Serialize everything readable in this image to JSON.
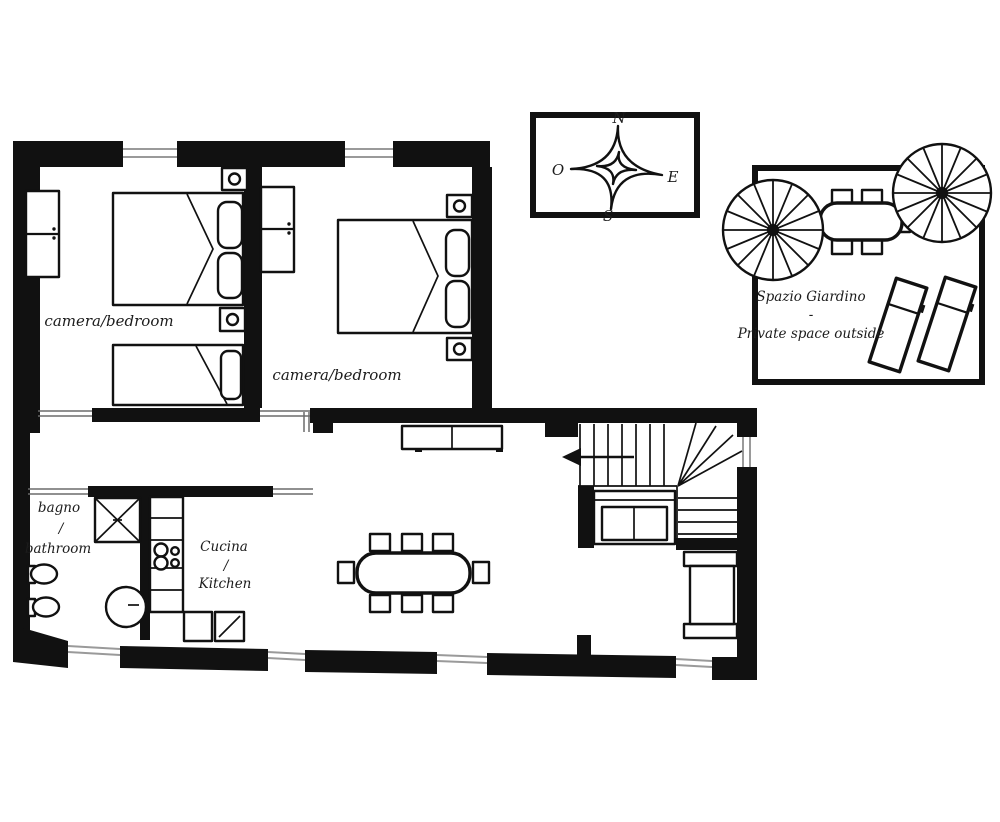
{
  "page": {
    "title": "Apartment floor plan with garden"
  },
  "colors": {
    "wall": "#111111",
    "furniture_line": "#111111",
    "window_line": "#9a9a9a",
    "door_line": "#6b6b6b",
    "background": "#ffffff"
  },
  "compass": {
    "north": "N",
    "east": "E",
    "south": "S",
    "west": "O"
  },
  "rooms": {
    "bedroom1": {
      "label": "camera/bedroom"
    },
    "bedroom2": {
      "label": "camera/bedroom"
    },
    "bathroom": {
      "line1": "bagno",
      "line2": "/",
      "line3": "bathroom"
    },
    "kitchen": {
      "line1": "Cucina",
      "line2": "/",
      "line3": "Kitchen"
    }
  },
  "garden": {
    "line1": "Spazio Giardino",
    "line2": "-",
    "line3": "Private space outside"
  }
}
